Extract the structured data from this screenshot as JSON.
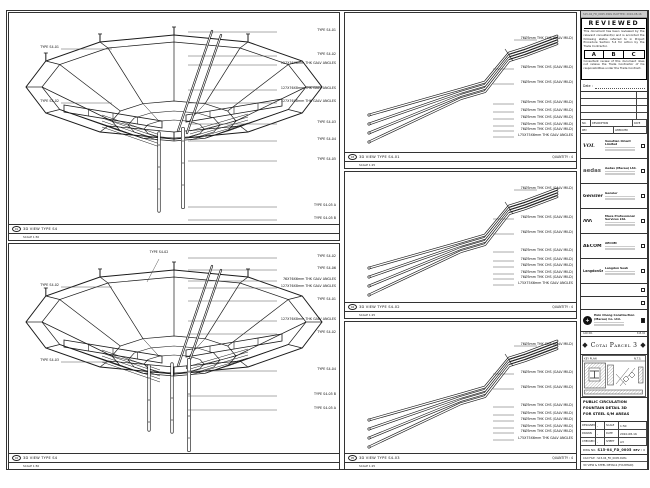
{
  "colors": {
    "line": "#1a1a1a",
    "paper": "#ffffff",
    "strip_bg": "#cccccc"
  },
  "sheet": {
    "plot_strip": "S15-04_FD_0005.DWG  PLOTTED: 2010-08-16"
  },
  "stamp": {
    "title": "REVIEWED",
    "p1": "This document has been reviewed by the relevant consultant(s) and is accorded the following status referred to in Project Procedure Section 5.4 for action by the Trade Contractor.",
    "abc": [
      "A",
      "B",
      "C"
    ],
    "p2": "Consultant review of this document does not relieve the Trade Contractor of his responsibilities under the Trade Contract.",
    "date_label": "Date :"
  },
  "rev_table": {
    "header": [
      "NO.",
      "DESCRIPTION",
      "DATE"
    ],
    "footer": [
      "REV",
      "APPROVED"
    ]
  },
  "consultants": [
    {
      "logo": "VOL",
      "name": "Venetian Orient Limited"
    },
    {
      "logo": "aedas",
      "name": "Aedas (Macau) Ltd."
    },
    {
      "logo": "Gensler",
      "name": "Gensler"
    },
    {
      "logo": "ΛΛΛ",
      "name": "Maca Professional Services Ltd."
    },
    {
      "logo": "AECOM",
      "name": "AECOM"
    },
    {
      "logo": "LangdonSeah",
      "name": "Langdon Seah"
    }
  ],
  "contractor": {
    "logo_glyph": "+",
    "name": "Hsin Chong Construction (Macau) Co. Ltd."
  },
  "cad_strip": {
    "left": "CAD NO.",
    "right": "S15-04"
  },
  "project": {
    "name": "Cotai Parcel 3",
    "badge": "◆"
  },
  "keyplan": {
    "left_label": "KEY PLAN",
    "right_label": "N.T.S."
  },
  "titleblock": {
    "title_lines": [
      "PUBLIC CIRCULATION",
      "FOUNTAIN DETAIL 3D",
      "FOR STEEL S/M AREAS"
    ],
    "fields": [
      [
        "DESIGNED",
        "-",
        "SCALE",
        "1:50"
      ],
      [
        "DRAWN",
        "-",
        "DATE",
        "2010-08-16"
      ],
      [
        "CHECKED",
        "-",
        "SHEET",
        "A3"
      ]
    ],
    "dwg_label": "DWG NO.",
    "dwg_no": "S15-04_FD_0005",
    "rev_label": "REV :",
    "rev_value": "0",
    "file_row1": "CAD FILE : S15-04_FD_0005.DWG",
    "file_row2": "3D VIEW & STEEL DETAILS (FOUNTAIN)"
  },
  "panels": [
    {
      "id": "01",
      "title": "3D VIEW TYPE S4",
      "scale": "SCALE 1:50",
      "quantity": "",
      "kind": "canopy",
      "geom": {
        "cx": 165,
        "cy": 74,
        "posts": [
          [
            150,
            120,
            198,
            0
          ],
          [
            174,
            116,
            194,
            1
          ]
        ]
      },
      "callouts_right": [
        {
          "y": 19,
          "t": "TYPE S4-01"
        },
        {
          "y": 43,
          "t": "TYPE S4-02"
        },
        {
          "y": 52,
          "t": "127X76X8mm THK GALV ANGLES"
        },
        {
          "y": 77,
          "t": "127X76X8mm THK GALV ANGLES"
        },
        {
          "y": 90,
          "t": "127X76X8mm THK GALV ANGLES"
        },
        {
          "y": 111,
          "t": "TYPE S4-03"
        },
        {
          "y": 128,
          "t": "TYPE S4-04"
        },
        {
          "y": 148,
          "t": "TYPE S4-05"
        },
        {
          "y": 194,
          "t": "TYPE S4-05 A"
        },
        {
          "y": 207,
          "t": "TYPE S4-05 B"
        }
      ],
      "callouts_left": [
        {
          "y": 36,
          "t": "TYPE S4-01"
        },
        {
          "y": 90,
          "t": "TYPE S4-02"
        }
      ]
    },
    {
      "id": "02",
      "title": "3D VIEW TYPE S4",
      "scale": "SCALE 1:50",
      "quantity": "",
      "kind": "canopy",
      "geom": {
        "cx": 165,
        "cy": 78,
        "posts": [
          [
            140,
            122,
            186,
            0
          ],
          [
            163,
            120,
            188,
            0
          ],
          [
            180,
            116,
            206,
            1
          ]
        ]
      },
      "callout_top": {
        "x": 150,
        "y": 10,
        "t": "TYPE S4-02"
      },
      "callouts_right": [
        {
          "y": 14,
          "t": "TYPE S4-02"
        },
        {
          "y": 26,
          "t": "TYPE S4-06"
        },
        {
          "y": 37,
          "t": "76X76X6mm THK GALV ANGLES"
        },
        {
          "y": 44,
          "t": "127X76X8mm THK GALV ANGLES"
        },
        {
          "y": 57,
          "t": "TYPE S4-01"
        },
        {
          "y": 77,
          "t": "127X76X8mm THK GALV ANGLES"
        },
        {
          "y": 90,
          "t": "TYPE S4-02"
        },
        {
          "y": 127,
          "t": "TYPE S4-04"
        },
        {
          "y": 152,
          "t": "TYPE S4-05 B"
        },
        {
          "y": 166,
          "t": "TYPE S4-05 A"
        }
      ],
      "callouts_left": [
        {
          "y": 43,
          "t": "TYPE S4-02"
        },
        {
          "y": 118,
          "t": "TYPE S4-03"
        }
      ]
    },
    {
      "id": "03",
      "title": "3D VIEW TYPE S4-01",
      "scale": "SCALE 1:25",
      "quantity": "QUANTITY : 4",
      "kind": "bundle",
      "geom": {
        "dy": 6
      },
      "callouts_right": [
        {
          "y": 27,
          "t": "76Ø5mm THK CHS (GALV MILD)"
        },
        {
          "y": 56,
          "t": "76Ø5mm THK CHS (GALV MILD)"
        },
        {
          "y": 71,
          "t": "76Ø5mm THK CHS (GALV MILD)"
        },
        {
          "y": 91,
          "t": "76Ø5mm THK CHS (GALV MILD)"
        },
        {
          "y": 99,
          "t": "76Ø5mm THK CHS (GALV MILD)"
        },
        {
          "y": 106,
          "t": "76Ø5mm THK CHS (GALV MILD)"
        },
        {
          "y": 113,
          "t": "76Ø5mm THK CHS (GALV MILD)"
        },
        {
          "y": 118,
          "t": "76Ø5mm THK CHS (GALV MILD)"
        },
        {
          "y": 124,
          "t": "L75X75X6mm THK GALV ANGLES"
        }
      ]
    },
    {
      "id": "04",
      "title": "3D VIEW TYPE S4-02",
      "scale": "SCALE 1:25",
      "quantity": "QUANTITY : 4",
      "kind": "bundle",
      "geom": {
        "dy": 0
      },
      "callouts_right": [
        {
          "y": 18,
          "t": "76Ø5mm THK CHS (GALV MILD)"
        },
        {
          "y": 47,
          "t": "76Ø5mm THK CHS (GALV MILD)"
        },
        {
          "y": 62,
          "t": "76Ø5mm THK CHS (GALV MILD)"
        },
        {
          "y": 80,
          "t": "76Ø5mm THK CHS (GALV MILD)"
        },
        {
          "y": 89,
          "t": "76Ø5mm THK CHS (GALV MILD)"
        },
        {
          "y": 95,
          "t": "76Ø5mm THK CHS (GALV MILD)"
        },
        {
          "y": 102,
          "t": "76Ø5mm THK CHS (GALV MILD)"
        },
        {
          "y": 107,
          "t": "76Ø5mm THK CHS (GALV MILD)"
        },
        {
          "y": 113,
          "t": "L75X75X6mm THK GALV ANGLES"
        }
      ]
    },
    {
      "id": "05",
      "title": "3D VIEW TYPE S4-03",
      "scale": "SCALE 1:25",
      "quantity": "QUANTITY : 4",
      "kind": "bundle",
      "geom": {
        "dy": 2
      },
      "callouts_right": [
        {
          "y": 24,
          "t": "76Ø5mm THK CHS (GALV MILD)"
        },
        {
          "y": 52,
          "t": "76Ø5mm THK CHS (GALV MILD)"
        },
        {
          "y": 67,
          "t": "76Ø5mm THK CHS (GALV MILD)"
        },
        {
          "y": 85,
          "t": "76Ø5mm THK CHS (GALV MILD)"
        },
        {
          "y": 93,
          "t": "76Ø5mm THK CHS (GALV MILD)"
        },
        {
          "y": 99,
          "t": "76Ø5mm THK CHS (GALV MILD)"
        },
        {
          "y": 106,
          "t": "76Ø5mm THK CHS (GALV MILD)"
        },
        {
          "y": 111,
          "t": "76Ø5mm THK CHS (GALV MILD)"
        },
        {
          "y": 118,
          "t": "L75X75X6mm THK GALV ANGLES"
        }
      ]
    }
  ]
}
